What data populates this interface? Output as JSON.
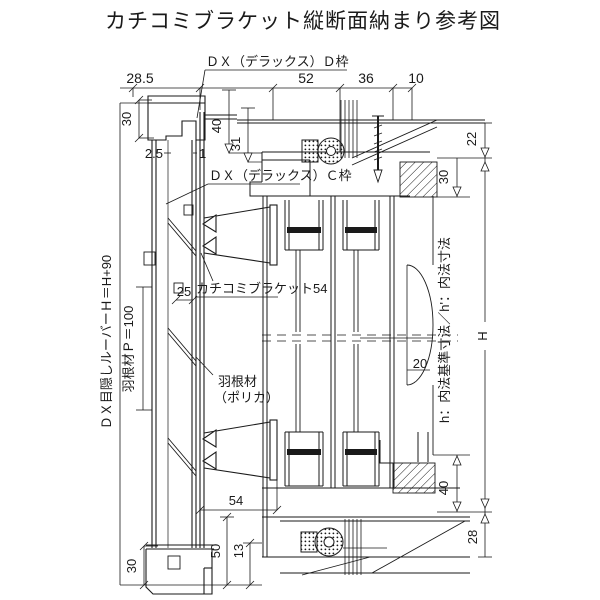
{
  "title": "カチコミブラケット縦断面納まり参考図",
  "colors": {
    "line": "#1a1a1a",
    "background": "#ffffff"
  },
  "annotations": {
    "dx_d_frame": "ＤＸ（デラックス）Ｄ枠",
    "dx_c_frame": "ＤＸ（デラックス）Ｃ枠",
    "kachikomi_bracket": "カチコミブラケット54",
    "blade_material_line1": "羽根材",
    "blade_material_line2": "（ポリカ）",
    "louver_height_note": "ＤＸ目隠しルーバーＨ＝H+90",
    "blade_pitch_note": "羽根材Ｐ＝100",
    "inner_dimension_note": "h：内法基準寸法／h'：内法寸法",
    "overall_height": "H"
  },
  "dimensions": {
    "top_left_depth": "28.5",
    "top_52": "52",
    "top_36": "36",
    "top_10": "10",
    "left_top_30": "30",
    "left_gap_2_5": "2.5",
    "left_gap_1": "1",
    "left_25": "25",
    "left_bottom_30": "30",
    "right_22": "22",
    "right_top_30": "30",
    "right_40_top": "40",
    "right_31": "31",
    "right_20": "20",
    "right_40_bottom": "40",
    "right_28": "28",
    "bottom_54": "54",
    "bottom_50": "50",
    "bottom_13": "13"
  }
}
